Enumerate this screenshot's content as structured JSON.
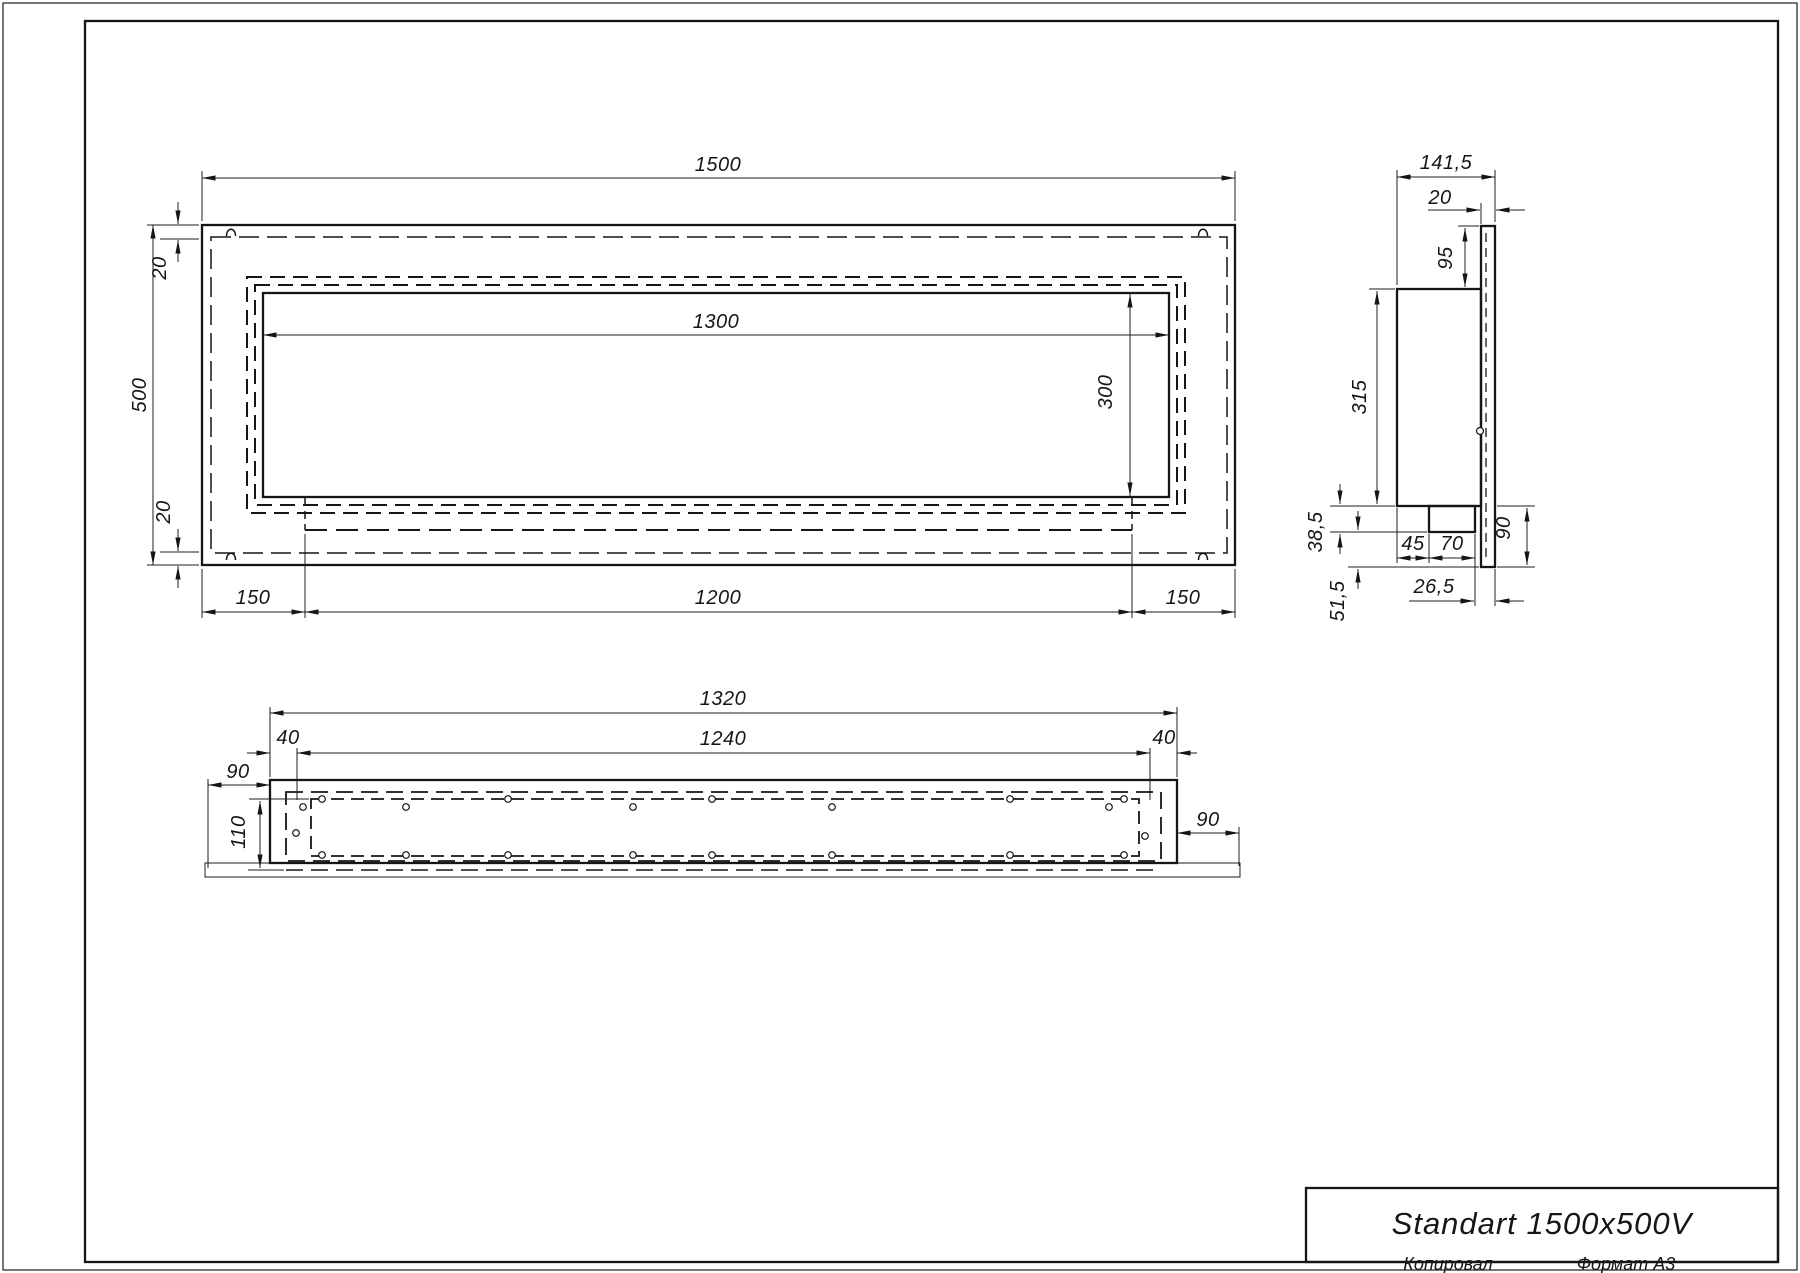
{
  "drawing": {
    "front_view": {
      "dim_width": "1500",
      "dim_height": "500",
      "dim_inset_top": "20",
      "dim_inset_bottom": "20",
      "dim_opening_width": "1300",
      "dim_opening_height": "300",
      "dim_margin_left": "150",
      "dim_tray_width": "1200",
      "dim_margin_right": "150"
    },
    "side_view": {
      "dim_depth": "141,5",
      "dim_panel_thickness": "20",
      "dim_top_offset": "95",
      "dim_body_height": "315",
      "dim_tray_depth": "38,5",
      "dim_bottom_drop": "51,5",
      "dim_tray_inset": "45",
      "dim_tray_width": "70",
      "dim_panel_drop": "90",
      "dim_front_offset": "26,5"
    },
    "bottom_view": {
      "dim_box_length": "1320",
      "dim_liner_length": "1240",
      "dim_end_left": "40",
      "dim_end_right": "40",
      "dim_overhang_left": "90",
      "dim_overhang_right": "90",
      "dim_inner_depth": "110"
    },
    "title_block": {
      "title": "Standart 1500x500V",
      "copied_by_label": "Копировал",
      "format_label": "Формат А3"
    }
  }
}
